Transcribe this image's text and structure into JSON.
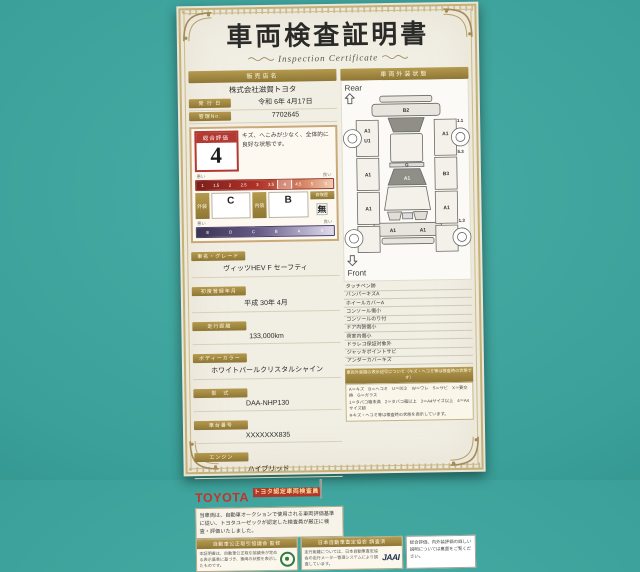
{
  "cert": {
    "title": "車両検査証明書",
    "subtitle": "Inspection Certificate",
    "left": {
      "dealer_label": "販売店名",
      "dealer_value": "株式会社滋賀トヨタ",
      "issue_label": "発 行 日",
      "issue_value": "令和 6年 4月17日",
      "manage_label": "管理No.",
      "manage_value": "7702645",
      "eval": {
        "label": "総合評価",
        "score": "4",
        "comment": "キズ、へこみが少なく、全体的に良好な状態です。",
        "scale_bad": "悪い",
        "scale_good": "良い",
        "overall_ticks": [
          "1",
          "1.5",
          "2",
          "2.5",
          "3",
          "3.5",
          "4",
          "4.5",
          "5",
          "S"
        ],
        "ext_label": "外装",
        "ext_value": "C",
        "int_label": "内装",
        "int_value": "B",
        "repair_label": "修復歴",
        "repair_value": "無",
        "grade_ticks": [
          "E",
          "D",
          "C",
          "B",
          "A",
          "S"
        ]
      },
      "fields": [
        {
          "label": "車名・グレード",
          "value": "ヴィッツHEV F セーフティ"
        },
        {
          "label": "初度登録年月",
          "value": "平成 30年 4月"
        },
        {
          "label": "走行距離",
          "value": "133,000km"
        },
        {
          "label": "ボディーカラー",
          "value": "ホワイトパールクリスタルシャイン"
        },
        {
          "label": "型　式",
          "value": "DAA-NHP130"
        },
        {
          "label": "車台番号",
          "value": "XXXXXXX835"
        },
        {
          "label": "エンジン",
          "value": "ハイブリッド"
        }
      ],
      "brand": "TOYOTA",
      "inspector_badge": "トヨタ認定車両検査員",
      "disclaimer": "当車両は、自動車オークションで使用される車両評価基準に従い、トヨタユーゼックが認定した検査員が厳正に検査・評価いたしました。"
    },
    "right": {
      "header": "車両外装状態",
      "rear_label": "Rear",
      "front_label": "Front",
      "marks": [
        "B2",
        "A1",
        "U1",
        "A1",
        "A1",
        "A1",
        "B3",
        "A1",
        "G",
        "A1",
        "A1",
        "A1"
      ],
      "readings": [
        "1.1",
        "5.3",
        "1.3"
      ],
      "defects": [
        "タッチペン跡",
        "バンパーキズA",
        "ホイールカバーA",
        "コンソール傷小",
        "コンソールのり付",
        "ドア内張傷小",
        "荷室内傷小",
        "ドラレコ保証対象外",
        "ジャッキポイントサビ",
        "アンダーカバーキズ"
      ],
      "legend_header": "車両外装図の表示記号について（キズ・ヘコミ等は検査時の状態です）",
      "legend_lines": [
        "A＝キズ　B＝ヘコミ　U＝凹ミ　W＝ワレ　S＝サビ　X＝要交換　G＝ガラス",
        "1＝タバコ箱未満　2＝タバコ箱以上　3＝A4サイズ以上　4＝A4サイズ超",
        "※キズ・ヘコミ等は検査時の状態を表示しています。"
      ]
    },
    "footer": {
      "box1_header": "自動車公正取引協議会 監修",
      "box1_body": "本証明書は、自動車公正取引協議会が定める表示基準に基づき、車両の状態を表示したものです。",
      "box2_header": "日本自動車査定協会 調査済",
      "box2_body": "走行距離については、日本自動車査定協会の走行メーター管理システムにより調査しています。",
      "box2_logo": "JAAI",
      "note": "総合評価、内外装評価の詳しい説明については裏面をご覧ください。"
    }
  }
}
